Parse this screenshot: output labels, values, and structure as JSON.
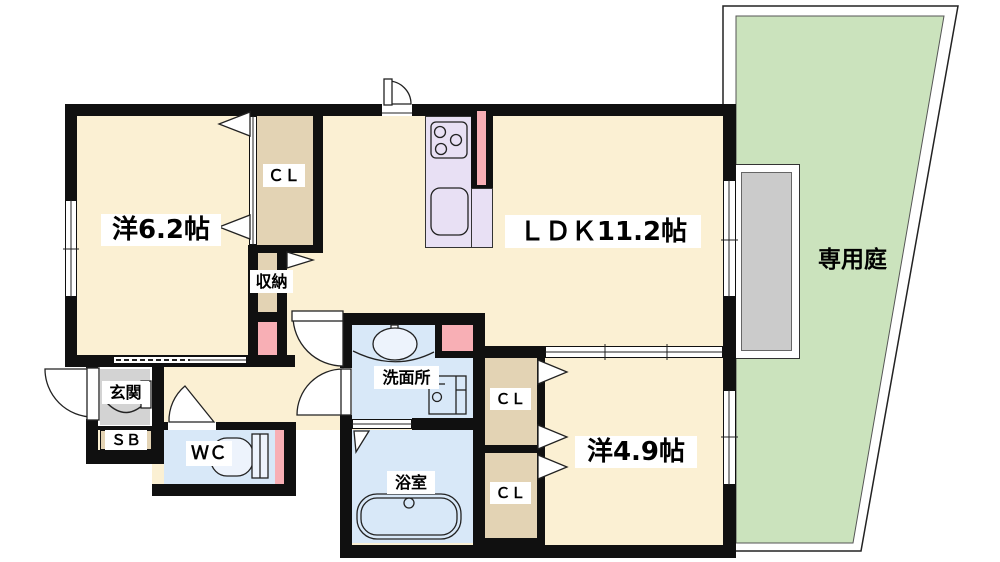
{
  "title": "間取り図",
  "palette": {
    "wall": "#101010",
    "floor": "#FBF0D3",
    "closet": "#E3D3B4",
    "wet": "#D8E8F8",
    "pink": "#F8AFB5",
    "kitchen": "#E8E0F4",
    "garden": "#CBE3BD",
    "terrace": "#CBCBCB",
    "genkan": "#D3D3D3",
    "line": "#222222"
  },
  "rooms": {
    "bedroom1": "洋6.2帖",
    "ldk": "ＬＤＫ11.2帖",
    "bedroom2": "洋4.9帖",
    "garden": "専用庭",
    "closet_bedroom1": "ＣＬ",
    "storage": "収納",
    "washroom": "洗面所",
    "bathroom": "浴室",
    "toilet": "ＷＣ",
    "entrance": "玄関",
    "shoe_box": "ＳＢ",
    "closet_upper": "ＣＬ",
    "closet_lower": "ＣＬ"
  }
}
